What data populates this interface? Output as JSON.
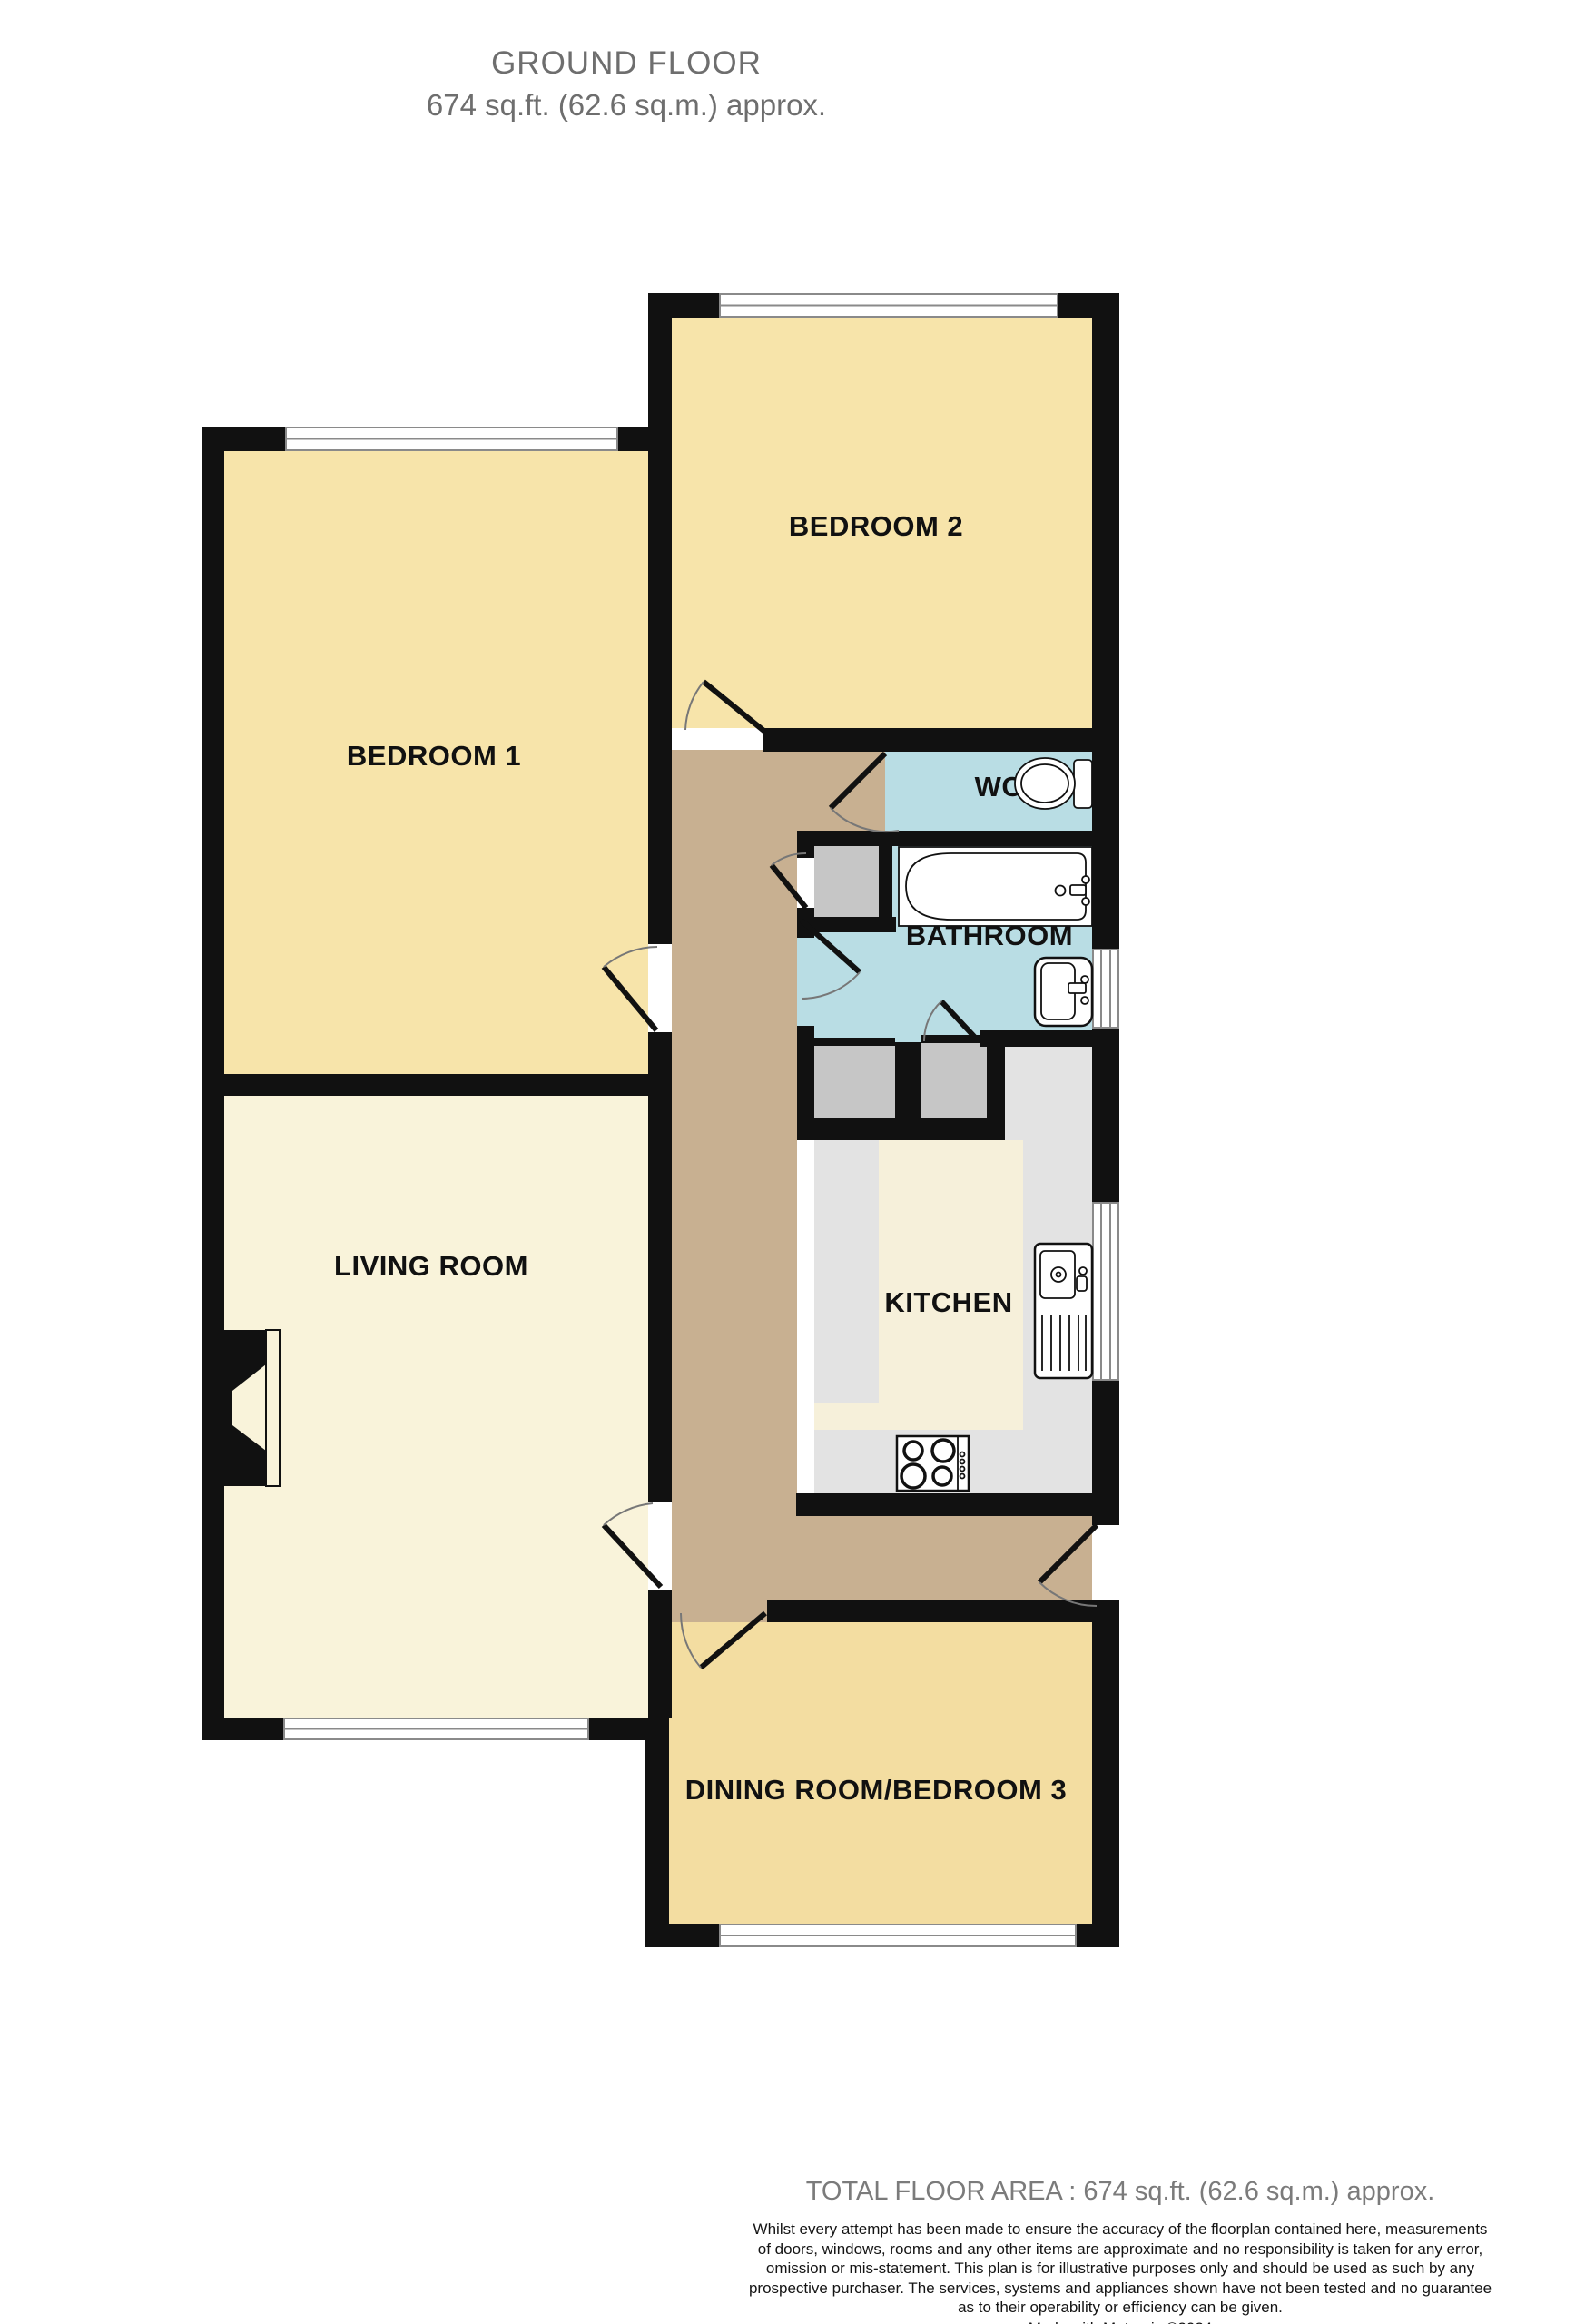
{
  "header": {
    "title": "GROUND FLOOR",
    "subtitle": "674 sq.ft. (62.6 sq.m.) approx."
  },
  "rooms": {
    "bedroom1": {
      "label": "BEDROOM 1"
    },
    "bedroom2": {
      "label": "BEDROOM 2"
    },
    "wc": {
      "label": "WC"
    },
    "bathroom": {
      "label": "BATHROOM"
    },
    "kitchen": {
      "label": "KITCHEN"
    },
    "living": {
      "label": "LIVING ROOM"
    },
    "dining": {
      "label": "DINING ROOM/BEDROOM 3"
    }
  },
  "footer": {
    "total": "TOTAL FLOOR AREA : 674 sq.ft. (62.6 sq.m.) approx.",
    "disclaimer_lines": [
      "Whilst every attempt has been made to ensure the accuracy of the floorplan contained here, measurements",
      "of doors, windows, rooms and any other items are approximate and no responsibility is taken for any error,",
      "omission or mis-statement. This plan is for illustrative purposes only and should be used as such by any",
      "prospective purchaser. The services, systems and appliances shown have not been tested and no guarantee",
      "as to their operability or efficiency can be given."
    ],
    "credit": "Made with Metropix ©2024"
  },
  "colors": {
    "background": "#ffffff",
    "wall": "#111111",
    "bedroom": "#f7e4aa",
    "living": "#f9f3da",
    "dining": "#f3dda1",
    "hallway": "#c8b091",
    "wet": "#b9dde4",
    "kitchen_floor": "#e3e3e3",
    "kitchen_counter": "#f6f0da",
    "cupboard": "#c6c6c6",
    "window_line": "#8a8a8a",
    "door_arc": "#777777",
    "title_text": "#6e6e6e",
    "footer_title_text": "#7b7b7b",
    "disclaimer_text": "#141414",
    "label_text": "#111111"
  }
}
